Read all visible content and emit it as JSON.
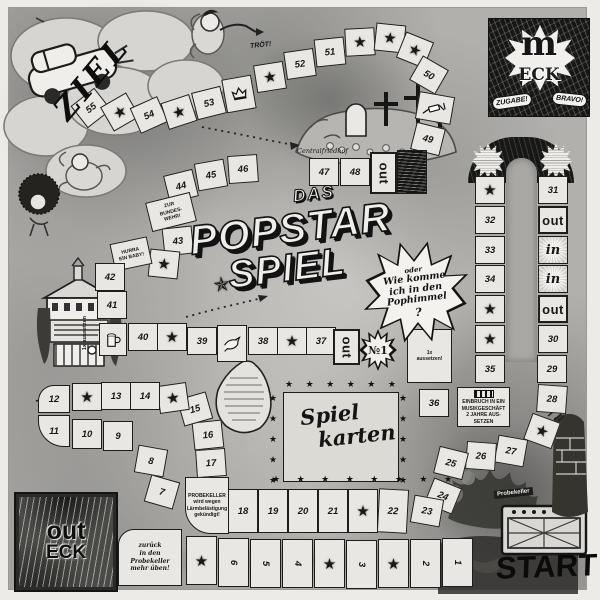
{
  "corners": {
    "ziel": "ZIEL",
    "m_eck_m": "m",
    "m_eck_eck": "ECK",
    "zugabe": "ZUGABE!",
    "bravo": "BRAVO!",
    "out_eck_out": "out",
    "out_eck_eck": "ECK",
    "start": "START"
  },
  "title": {
    "das": "DAS",
    "popstar": "POPSTAR",
    "spiel": "SPIEL"
  },
  "burst": {
    "l1": "oder",
    "l2": "Wie komme",
    "l3": "ich in den",
    "l4": "Pophimmel",
    "l5": "?"
  },
  "center_box": {
    "line1": "Spiel",
    "line2": "karten",
    "stars_top": "★ ★ ★ ★ ★ ★",
    "stars_bottom": "★ ★ ★ ★ ★ ★ ★ ★",
    "stars_left": "★ ★ ★ ★ ★",
    "stars_right": "★ ★ ★ ★ ★"
  },
  "labels": {
    "troet": "TRÖT!",
    "friedhof": "Centralfriedhof",
    "aussetzen_vert": "1x aussetzen",
    "probekeller_tag": "Probekeller"
  },
  "path_words": {
    "out": "out",
    "in": "in",
    "star": "★",
    "no1": "№1"
  },
  "specials": {
    "bundeswehr": [
      "ZUR",
      "BUNDES-",
      "WEHR!"
    ],
    "baby": [
      "HURRA",
      "EIN BABY!"
    ],
    "aussetzen": [
      "1x",
      "aussetzen!"
    ],
    "jail": [
      "EINBRUCH IN EIN",
      "MUSIKGESCHÄFT",
      "2 JAHRE AUS-",
      "SETZEN"
    ],
    "probekeller": [
      "PROBEKELLER",
      "wird wegen",
      "Lärmbelästigung",
      "gekündigt!"
    ],
    "zurueck": [
      "zurück",
      "in den",
      "Probekeller",
      "mehr üben!"
    ]
  },
  "cells": [
    {
      "x": 76,
      "y": 94,
      "t": "n",
      "l": "55",
      "r": -38
    },
    {
      "x": 105,
      "y": 98,
      "t": "s",
      "r": -30
    },
    {
      "x": 134,
      "y": 101,
      "t": "n",
      "l": "54",
      "r": -24
    },
    {
      "x": 164,
      "y": 98,
      "t": "s",
      "r": -18
    },
    {
      "x": 194,
      "y": 89,
      "t": "n",
      "l": "53",
      "r": -14
    },
    {
      "x": 224,
      "y": 77,
      "t": "i",
      "icon": "crown-icon",
      "w": 30,
      "h": 34,
      "r": -10
    },
    {
      "x": 255,
      "y": 63,
      "t": "s",
      "r": -9
    },
    {
      "x": 285,
      "y": 50,
      "t": "n",
      "l": "52",
      "r": -8
    },
    {
      "x": 315,
      "y": 38,
      "t": "n",
      "l": "51",
      "r": -6
    },
    {
      "x": 345,
      "y": 28,
      "t": "s",
      "r": -3
    },
    {
      "x": 375,
      "y": 24,
      "t": "s",
      "r": 6
    },
    {
      "x": 400,
      "y": 36,
      "t": "s",
      "r": 22
    },
    {
      "x": 414,
      "y": 61,
      "t": "n",
      "l": "50",
      "r": 30
    },
    {
      "x": 417,
      "y": 94,
      "t": "i",
      "icon": "syringe-icon",
      "w": 36,
      "h": 28,
      "r": 10
    },
    {
      "x": 413,
      "y": 125,
      "t": "n",
      "l": "49",
      "r": 14
    },
    {
      "x": 397,
      "y": 150,
      "t": "x",
      "w": 30,
      "h": 44
    },
    {
      "x": 370,
      "y": 152,
      "t": "o",
      "vert": 1,
      "w": 27,
      "h": 42
    },
    {
      "x": 340,
      "y": 158,
      "t": "n",
      "l": "48"
    },
    {
      "x": 309,
      "y": 158,
      "t": "n",
      "l": "47"
    },
    {
      "x": 228,
      "y": 155,
      "t": "n",
      "l": "46",
      "r": -4
    },
    {
      "x": 196,
      "y": 161,
      "t": "n",
      "l": "45",
      "r": -10
    },
    {
      "x": 166,
      "y": 172,
      "t": "n",
      "l": "44",
      "r": -14
    },
    {
      "x": 148,
      "y": 197,
      "t": "sp",
      "l": "bundeswehr",
      "w": 46,
      "h": 30,
      "r": -14
    },
    {
      "x": 163,
      "y": 227,
      "t": "n",
      "l": "43",
      "r": -6
    },
    {
      "x": 149,
      "y": 250,
      "t": "s",
      "r": 6
    },
    {
      "x": 112,
      "y": 240,
      "t": "sp",
      "l": "baby",
      "w": 38,
      "h": 28,
      "r": -12
    },
    {
      "x": 95,
      "y": 263,
      "t": "n",
      "l": "42"
    },
    {
      "x": 97,
      "y": 291,
      "t": "n",
      "l": "41"
    },
    {
      "x": 99,
      "y": 323,
      "t": "i",
      "icon": "beer-mug-icon",
      "w": 28,
      "h": 33
    },
    {
      "x": 128,
      "y": 323,
      "t": "n",
      "l": "40"
    },
    {
      "x": 157,
      "y": 323,
      "t": "s"
    },
    {
      "x": 187,
      "y": 327,
      "t": "n",
      "l": "39"
    },
    {
      "x": 217,
      "y": 325,
      "t": "i",
      "icon": "dove-icon",
      "w": 30,
      "h": 37
    },
    {
      "x": 248,
      "y": 327,
      "t": "n",
      "l": "38"
    },
    {
      "x": 277,
      "y": 327,
      "t": "s"
    },
    {
      "x": 306,
      "y": 327,
      "t": "n",
      "l": "37"
    },
    {
      "x": 333,
      "y": 329,
      "t": "o",
      "vert": 1,
      "w": 27,
      "h": 36
    },
    {
      "x": 361,
      "y": 331,
      "t": "no1",
      "w": 34,
      "h": 38
    },
    {
      "x": 407,
      "y": 329,
      "t": "sp",
      "l": "aussetzen",
      "w": 45,
      "h": 54
    },
    {
      "x": 419,
      "y": 389,
      "t": "n",
      "l": "36"
    },
    {
      "x": 457,
      "y": 387,
      "t": "sp",
      "l": "jail",
      "w": 53,
      "h": 40,
      "bars": 1
    },
    {
      "x": 475,
      "y": 355,
      "t": "n",
      "l": "35"
    },
    {
      "x": 475,
      "y": 325,
      "t": "s"
    },
    {
      "x": 475,
      "y": 295,
      "t": "s"
    },
    {
      "x": 475,
      "y": 265,
      "t": "n",
      "l": "34"
    },
    {
      "x": 475,
      "y": 236,
      "t": "n",
      "l": "33"
    },
    {
      "x": 475,
      "y": 206,
      "t": "n",
      "l": "32"
    },
    {
      "x": 475,
      "y": 176,
      "t": "s"
    },
    {
      "x": 538,
      "y": 176,
      "t": "n",
      "l": "31"
    },
    {
      "x": 538,
      "y": 206,
      "t": "o"
    },
    {
      "x": 538,
      "y": 236,
      "t": "in"
    },
    {
      "x": 538,
      "y": 265,
      "t": "in"
    },
    {
      "x": 538,
      "y": 295,
      "t": "o"
    },
    {
      "x": 538,
      "y": 325,
      "t": "n",
      "l": "30"
    },
    {
      "x": 537,
      "y": 355,
      "t": "n",
      "l": "29"
    },
    {
      "x": 537,
      "y": 385,
      "t": "n",
      "l": "28",
      "r": 4
    },
    {
      "x": 527,
      "y": 417,
      "t": "s",
      "r": 20
    },
    {
      "x": 496,
      "y": 437,
      "t": "n",
      "l": "27",
      "r": 10
    },
    {
      "x": 466,
      "y": 442,
      "t": "n",
      "l": "26",
      "r": 4
    },
    {
      "x": 436,
      "y": 449,
      "t": "n",
      "l": "25",
      "r": 14
    },
    {
      "x": 428,
      "y": 482,
      "t": "n",
      "l": "24",
      "r": 22
    },
    {
      "x": 412,
      "y": 497,
      "t": "n",
      "l": "23",
      "r": 10
    },
    {
      "x": 378,
      "y": 489,
      "t": "n",
      "l": "22",
      "h": 44,
      "r": 3
    },
    {
      "x": 348,
      "y": 489,
      "t": "s",
      "h": 44
    },
    {
      "x": 318,
      "y": 489,
      "t": "n",
      "l": "21",
      "h": 44
    },
    {
      "x": 288,
      "y": 489,
      "t": "n",
      "l": "20",
      "h": 44
    },
    {
      "x": 258,
      "y": 489,
      "t": "n",
      "l": "19",
      "h": 44
    },
    {
      "x": 228,
      "y": 489,
      "t": "n",
      "l": "18",
      "h": 44
    },
    {
      "x": 185,
      "y": 477,
      "t": "sp",
      "l": "probekeller",
      "w": 44,
      "h": 57,
      "round": "bl"
    },
    {
      "x": 196,
      "y": 449,
      "t": "n",
      "l": "17",
      "r": -4
    },
    {
      "x": 193,
      "y": 421,
      "t": "n",
      "l": "16",
      "r": -6
    },
    {
      "x": 180,
      "y": 395,
      "t": "n",
      "l": "15",
      "r": -16
    },
    {
      "x": 158,
      "y": 384,
      "t": "s",
      "r": -8
    },
    {
      "x": 130,
      "y": 382,
      "t": "n",
      "l": "14"
    },
    {
      "x": 101,
      "y": 382,
      "t": "n",
      "l": "13"
    },
    {
      "x": 72,
      "y": 383,
      "t": "s"
    },
    {
      "x": 38,
      "y": 385,
      "t": "n",
      "l": "12",
      "w": 32,
      "round": "tl"
    },
    {
      "x": 38,
      "y": 415,
      "t": "n",
      "l": "11",
      "w": 32,
      "h": 32,
      "round": "bl"
    },
    {
      "x": 72,
      "y": 419,
      "t": "n",
      "l": "10",
      "h": 30
    },
    {
      "x": 103,
      "y": 421,
      "t": "n",
      "l": "9",
      "h": 30
    },
    {
      "x": 136,
      "y": 447,
      "t": "n",
      "l": "8",
      "r": 10
    },
    {
      "x": 147,
      "y": 478,
      "t": "n",
      "l": "7",
      "r": 16
    },
    {
      "x": 118,
      "y": 529,
      "t": "sp",
      "l": "zurueck",
      "w": 64,
      "h": 57,
      "lc": 1,
      "round": "tl"
    },
    {
      "x": 186,
      "y": 536,
      "t": "s",
      "w": 31,
      "h": 49
    },
    {
      "x": 218,
      "y": 538,
      "t": "n",
      "l": "6",
      "w": 31,
      "h": 49,
      "dr": 90
    },
    {
      "x": 250,
      "y": 539,
      "t": "n",
      "l": "5",
      "w": 31,
      "h": 49,
      "dr": 90
    },
    {
      "x": 282,
      "y": 539,
      "t": "n",
      "l": "4",
      "w": 31,
      "h": 49,
      "dr": 90
    },
    {
      "x": 314,
      "y": 539,
      "t": "s",
      "w": 31,
      "h": 49
    },
    {
      "x": 346,
      "y": 540,
      "t": "n",
      "l": "3",
      "w": 31,
      "h": 49,
      "dr": 90
    },
    {
      "x": 378,
      "y": 539,
      "t": "s",
      "w": 31,
      "h": 49
    },
    {
      "x": 410,
      "y": 539,
      "t": "n",
      "l": "2",
      "w": 31,
      "h": 49,
      "dr": 90
    },
    {
      "x": 442,
      "y": 538,
      "t": "n",
      "l": "1",
      "w": 31,
      "h": 49,
      "dr": 90
    }
  ]
}
